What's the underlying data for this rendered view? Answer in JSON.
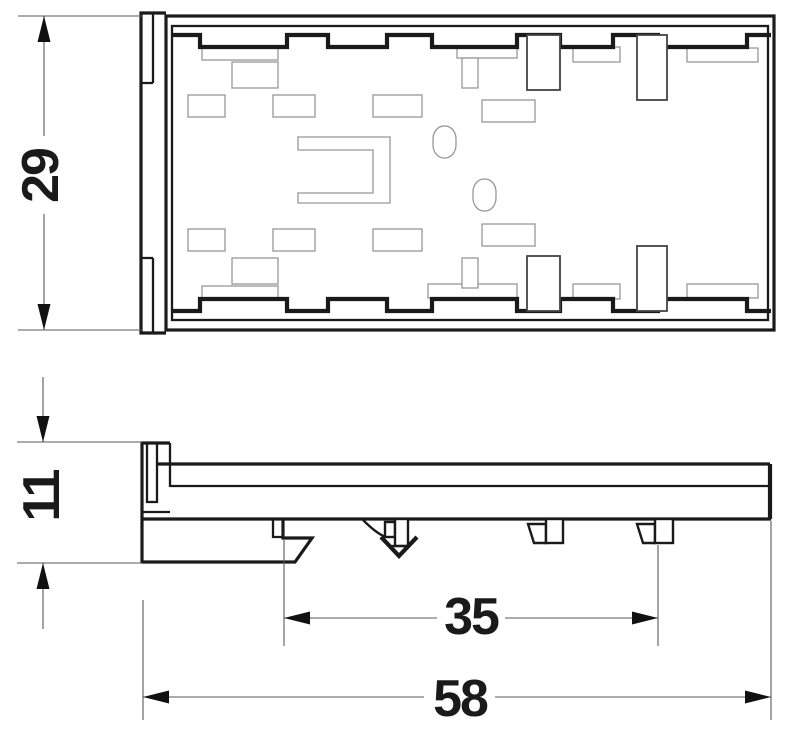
{
  "page": {
    "background": "#ffffff"
  },
  "colors": {
    "outline": "#1a1a1a",
    "thin_line": "#979797",
    "dimension_line": "#5a5a5a",
    "text": "#1a1a1a",
    "background": "#ffffff"
  },
  "dimensions": {
    "overall_height": {
      "value": "29"
    },
    "profile_height": {
      "value": "11"
    },
    "rail_span": {
      "value": "35"
    },
    "overall_width": {
      "value": "58"
    }
  },
  "drawing": {
    "shapes": [
      {
        "type": "path",
        "name": "top-view-flange-outline",
        "cls": "thick",
        "attrs": {
          "d": "M166,13 H141 V333 H166"
        }
      },
      {
        "type": "path",
        "name": "top-view-flange-tab-top",
        "cls": "thick2",
        "attrs": {
          "d": "M153,13 V83 M141,83 H153"
        }
      },
      {
        "type": "path",
        "name": "top-view-flange-tab-bottom",
        "cls": "thick2",
        "attrs": {
          "d": "M153,333 V258 M141,258 H153"
        }
      },
      {
        "type": "rect",
        "name": "top-view-outer-wall",
        "cls": "thick",
        "attrs": {
          "x": 166,
          "y": 16,
          "width": 608,
          "height": 314
        }
      },
      {
        "type": "rect",
        "name": "top-view-inner-wall",
        "cls": "thick2",
        "attrs": {
          "x": 172,
          "y": 26,
          "width": 596,
          "height": 294
        }
      },
      {
        "type": "rect",
        "name": "slot-rect",
        "cls": "thin",
        "attrs": {
          "x": 202,
          "y": 48,
          "width": 76,
          "height": 12
        }
      },
      {
        "type": "rect",
        "name": "slot-rect",
        "cls": "thin",
        "attrs": {
          "x": 202,
          "y": 286,
          "width": 76,
          "height": 12
        }
      },
      {
        "type": "rect",
        "name": "slot-rect",
        "cls": "thin",
        "attrs": {
          "x": 232,
          "y": 62,
          "width": 46,
          "height": 26
        }
      },
      {
        "type": "rect",
        "name": "slot-rect",
        "cls": "thin",
        "attrs": {
          "x": 232,
          "y": 258,
          "width": 46,
          "height": 26
        }
      },
      {
        "type": "rect",
        "name": "slot-rect",
        "cls": "thin",
        "attrs": {
          "x": 188,
          "y": 95,
          "width": 37,
          "height": 22
        }
      },
      {
        "type": "rect",
        "name": "slot-rect",
        "cls": "thin",
        "attrs": {
          "x": 188,
          "y": 229,
          "width": 37,
          "height": 22
        }
      },
      {
        "type": "rect",
        "name": "slot-rect",
        "cls": "thin",
        "attrs": {
          "x": 273,
          "y": 95,
          "width": 42,
          "height": 22
        }
      },
      {
        "type": "rect",
        "name": "slot-rect",
        "cls": "thin",
        "attrs": {
          "x": 273,
          "y": 229,
          "width": 42,
          "height": 22
        }
      },
      {
        "type": "rect",
        "name": "slot-rect",
        "cls": "thin",
        "attrs": {
          "x": 373,
          "y": 95,
          "width": 49,
          "height": 22
        }
      },
      {
        "type": "rect",
        "name": "slot-rect",
        "cls": "thin",
        "attrs": {
          "x": 373,
          "y": 229,
          "width": 49,
          "height": 22
        }
      },
      {
        "type": "rect",
        "name": "slot-rect",
        "cls": "thin",
        "attrs": {
          "x": 457,
          "y": 48,
          "width": 60,
          "height": 10
        }
      },
      {
        "type": "rect",
        "name": "slot-rect",
        "cls": "thin",
        "attrs": {
          "x": 428,
          "y": 284,
          "width": 89,
          "height": 14
        }
      },
      {
        "type": "rect",
        "name": "slot-rect",
        "cls": "thin",
        "attrs": {
          "x": 573,
          "y": 47,
          "width": 47,
          "height": 15
        }
      },
      {
        "type": "rect",
        "name": "slot-rect",
        "cls": "thin",
        "attrs": {
          "x": 573,
          "y": 284,
          "width": 47,
          "height": 15
        }
      },
      {
        "type": "rect",
        "name": "slot-rect",
        "cls": "thin",
        "attrs": {
          "x": 687,
          "y": 48,
          "width": 71,
          "height": 14
        }
      },
      {
        "type": "rect",
        "name": "slot-rect",
        "cls": "thin",
        "attrs": {
          "x": 687,
          "y": 284,
          "width": 71,
          "height": 14
        }
      },
      {
        "type": "rect",
        "name": "slot-rect",
        "cls": "thin",
        "attrs": {
          "x": 462,
          "y": 58,
          "width": 16,
          "height": 30
        }
      },
      {
        "type": "rect",
        "name": "slot-rect",
        "cls": "thin",
        "attrs": {
          "x": 462,
          "y": 258,
          "width": 16,
          "height": 30
        }
      },
      {
        "type": "rect",
        "name": "slot-rect",
        "cls": "thin",
        "attrs": {
          "x": 482,
          "y": 100,
          "width": 53,
          "height": 22
        }
      },
      {
        "type": "rect",
        "name": "slot-rect",
        "cls": "thin",
        "attrs": {
          "x": 482,
          "y": 224,
          "width": 53,
          "height": 22
        }
      },
      {
        "type": "rect",
        "name": "stadium-hole",
        "cls": "thin",
        "attrs": {
          "x": 433,
          "y": 126,
          "width": 23,
          "height": 32,
          "rx": 11,
          "ry": 13
        }
      },
      {
        "type": "rect",
        "name": "stadium-hole",
        "cls": "thin",
        "attrs": {
          "x": 473,
          "y": 179,
          "width": 23,
          "height": 32,
          "rx": 11,
          "ry": 13
        }
      },
      {
        "type": "path",
        "name": "bracket-cutout",
        "cls": "thin",
        "attrs": {
          "d": "M298,137 H390 V203 H298 V193 H373 V150 H298 Z"
        }
      },
      {
        "type": "path",
        "name": "castellation-top",
        "cls": "thick3",
        "attrs": {
          "d": "M172,35 H200 V47 H287 V35 H328 V47 H387 V35 H432 V47 H517 V35 H560 V47 H613 V35 H658 V47 H747 V35 H771"
        }
      },
      {
        "type": "path",
        "name": "castellation-bottom",
        "cls": "thick3",
        "attrs": {
          "d": "M172,311 H200 V299 H287 V311 H328 V299 H387 V311 H432 V299 H517 V311 H560 V299 H613 V311 H658 V299 H747 V311 H771"
        }
      },
      {
        "type": "rect",
        "name": "terminal-slot",
        "cls": "midfill",
        "attrs": {
          "x": 527,
          "y": 35,
          "width": 33,
          "height": 55
        }
      },
      {
        "type": "rect",
        "name": "terminal-slot",
        "cls": "midfill",
        "attrs": {
          "x": 527,
          "y": 256,
          "width": 33,
          "height": 55
        }
      },
      {
        "type": "rect",
        "name": "terminal-slot",
        "cls": "midfill",
        "attrs": {
          "x": 637,
          "y": 35,
          "width": 30,
          "height": 65
        }
      },
      {
        "type": "rect",
        "name": "terminal-slot",
        "cls": "midfill",
        "attrs": {
          "x": 637,
          "y": 246,
          "width": 30,
          "height": 65
        }
      },
      {
        "type": "path",
        "name": "side-view-flange",
        "cls": "thick",
        "attrs": {
          "d": "M170,443 H142 V519"
        }
      },
      {
        "type": "path",
        "name": "side-view-flange-bar",
        "cls": "thick2",
        "attrs": {
          "d": "M147,443 V502 H157 V443"
        }
      },
      {
        "type": "path",
        "name": "side-view-flange-step",
        "cls": "thick2",
        "attrs": {
          "d": "M142,512 H170"
        }
      },
      {
        "type": "path",
        "name": "side-view-flange-stub",
        "cls": "thick2",
        "attrs": {
          "d": "M170,443 V487"
        }
      },
      {
        "type": "path",
        "name": "side-view-body-top",
        "cls": "thick",
        "attrs": {
          "d": "M158,464 H770"
        }
      },
      {
        "type": "path",
        "name": "side-view-body-inner",
        "cls": "thick2",
        "attrs": {
          "d": "M170,486 H770"
        }
      },
      {
        "type": "path",
        "name": "side-view-body-bottom",
        "cls": "thick",
        "attrs": {
          "d": "M142,519 H771"
        }
      },
      {
        "type": "path",
        "name": "side-view-body-right",
        "cls": "thick3",
        "attrs": {
          "d": "M770,464 V519"
        }
      },
      {
        "type": "path",
        "name": "side-view-foot",
        "cls": "thick",
        "attrs": {
          "d": "M142,519 V562 H295 L312,538 H283 V519"
        }
      },
      {
        "type": "path",
        "name": "side-view-foot-tab",
        "cls": "thick2",
        "attrs": {
          "d": "M273,519 V537 H283"
        }
      },
      {
        "type": "path",
        "name": "din-latch-arc",
        "cls": "thick2",
        "attrs": {
          "d": "M363,520 Q377,534 386,537"
        }
      },
      {
        "type": "rect",
        "name": "din-latch-square",
        "cls": "thickfill",
        "attrs": {
          "x": 385,
          "y": 522,
          "width": 10,
          "height": 15
        }
      },
      {
        "type": "rect",
        "name": "din-latch-bar",
        "cls": "thickfill",
        "attrs": {
          "x": 395,
          "y": 519,
          "width": 13,
          "height": 27
        }
      },
      {
        "type": "path",
        "name": "din-latch-tip",
        "cls": "thick3",
        "attrs": {
          "d": "M381,537 L399,556 L417,537"
        }
      },
      {
        "type": "path",
        "name": "din-latch-tip-line",
        "cls": "thick2",
        "attrs": {
          "d": "M391,546 H407"
        }
      },
      {
        "type": "polygon",
        "name": "rail-tab-flag",
        "cls": "thickfill",
        "attrs": {
          "points": "528,524 546,524 546,543 534,543"
        }
      },
      {
        "type": "rect",
        "name": "rail-tab-square",
        "cls": "thickfill",
        "attrs": {
          "x": 546,
          "y": 519,
          "width": 17,
          "height": 24
        }
      },
      {
        "type": "polygon",
        "name": "rail-tab-flag",
        "cls": "thickfill",
        "attrs": {
          "points": "637,524 655,524 655,543 643,543"
        }
      },
      {
        "type": "rect",
        "name": "rail-tab-square",
        "cls": "thickfill",
        "attrs": {
          "x": 655,
          "y": 519,
          "width": 18,
          "height": 24
        }
      },
      {
        "type": "path",
        "name": "dim-29-lines",
        "cls": "dim",
        "attrs": {
          "d": "M18,16 H143 M18,330 H143 M44,16 V136 M44,214 V330"
        }
      },
      {
        "type": "polygon",
        "name": "dim-29-arrow-up",
        "cls": "arrow",
        "attrs": {
          "points": "44,16 37.5,42 50.5,42"
        }
      },
      {
        "type": "polygon",
        "name": "dim-29-arrow-down",
        "cls": "arrow",
        "attrs": {
          "points": "44,330 37.5,304 50.5,304"
        }
      },
      {
        "type": "path",
        "name": "dim-11-lines",
        "cls": "dim",
        "attrs": {
          "d": "M17,442 H142 M17,563 H142 M43,377 V442 M43,563 V629"
        }
      },
      {
        "type": "polygon",
        "name": "dim-11-arrow-down",
        "cls": "arrow",
        "attrs": {
          "points": "43,442 36.5,416 49.5,416"
        }
      },
      {
        "type": "polygon",
        "name": "dim-11-arrow-up",
        "cls": "arrow",
        "attrs": {
          "points": "43,563 36.5,589 49.5,589"
        }
      },
      {
        "type": "path",
        "name": "dim-35-lines",
        "cls": "dim",
        "attrs": {
          "d": "M284,540 V646 M658,545 V646 M284,618 H437 M505,618 H658"
        }
      },
      {
        "type": "polygon",
        "name": "dim-35-arrow-left",
        "cls": "arrow",
        "attrs": {
          "points": "284,618 310,611.5 310,624.5"
        }
      },
      {
        "type": "polygon",
        "name": "dim-35-arrow-right",
        "cls": "arrow",
        "attrs": {
          "points": "658,618 632,611.5 632,624.5"
        }
      },
      {
        "type": "path",
        "name": "dim-58-lines",
        "cls": "dim",
        "attrs": {
          "d": "M143,600 V720 M771,521 V720 M143,697 H424 M495,697 H771"
        }
      },
      {
        "type": "polygon",
        "name": "dim-58-arrow-left",
        "cls": "arrow",
        "attrs": {
          "points": "143,697 169,690.5 169,703.5"
        }
      },
      {
        "type": "polygon",
        "name": "dim-58-arrow-right",
        "cls": "arrow",
        "attrs": {
          "points": "771,697 745,690.5 745,703.5"
        }
      }
    ]
  }
}
